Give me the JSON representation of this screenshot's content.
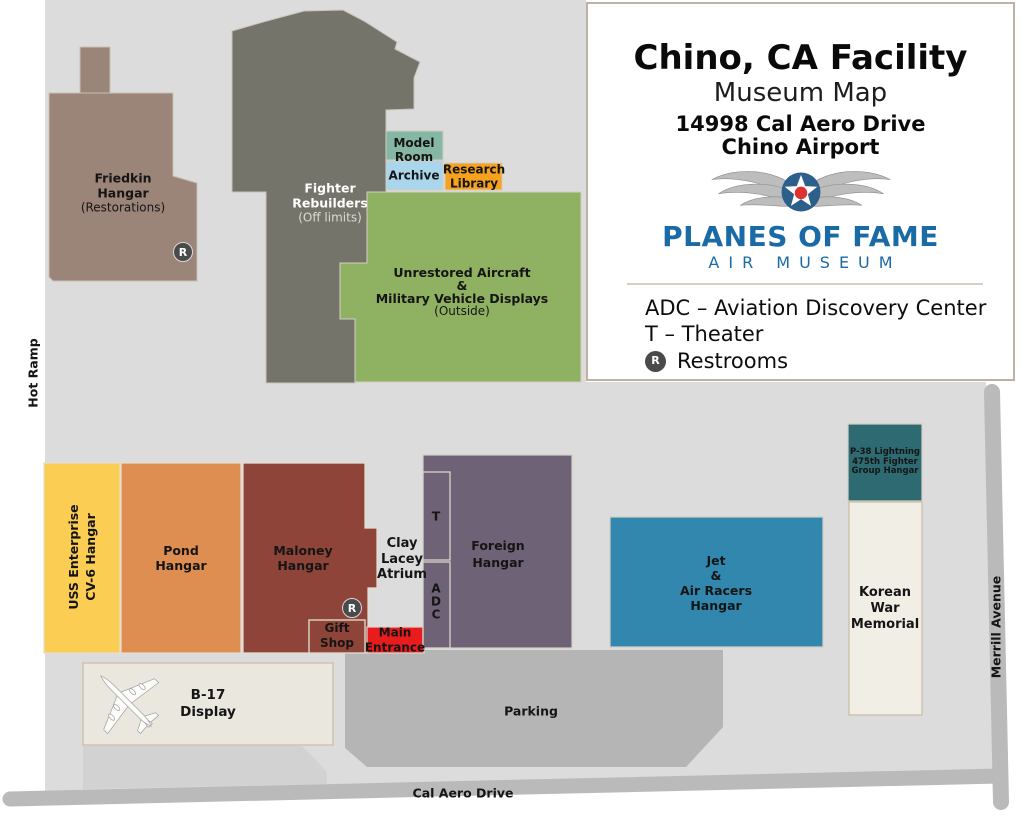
{
  "colors": {
    "ground": "#dcdcdc",
    "parking": "#b5b5b5",
    "road": "#bababa",
    "driveway": "#d2d2d2",
    "friedkin": "#9b8478",
    "fighter_rebuilders": "#75746b",
    "model_room": "#85b7a4",
    "archive": "#a9d6ea",
    "research_library": "#f6a21d",
    "unrestored_area": "#8fb162",
    "uss_enterprise": "#fbcd52",
    "pond": "#dd8e50",
    "maloney": "#8f4439",
    "gift_shop": "#8f4439",
    "main_entrance": "#e81c1c",
    "foreign": "#6e6277",
    "jet_air_racers": "#3287ae",
    "p38": "#2d6a72",
    "korean_memorial": "#f1eee6",
    "b17_display": "#eae7de",
    "restroom_marker": "#4a4a4a",
    "brand_blue": "#1a6aa6",
    "roundel_blue": "#2d5f8b",
    "roundel_red": "#dd3330"
  },
  "info_panel": {
    "title": "Chino, CA Facility",
    "subtitle": "Museum Map",
    "address_line1": "14998 Cal Aero Drive",
    "address_line2": "Chino Airport",
    "brand_name": "PLANES OF FAME",
    "brand_subtitle": "AIR MUSEUM",
    "legend_adc": "ADC – Aviation Discovery Center",
    "legend_theater": "T – Theater",
    "legend_restrooms": "Restrooms"
  },
  "buildings": {
    "friedkin": {
      "line1": "Friedkin",
      "line2": "Hangar",
      "note": "(Restorations)"
    },
    "fighter_rebuilders": {
      "line1": "Fighter",
      "line2": "Rebuilders",
      "note": "(Off limits)"
    },
    "model_room": {
      "line1": "Model",
      "line2": "Room"
    },
    "archive": {
      "label": "Archive"
    },
    "research_library": {
      "line1": "Research",
      "line2": "Library"
    },
    "unrestored": {
      "line1": "Unrestored Aircraft",
      "line2": "&",
      "line3": "Military Vehicle Displays",
      "note": "(Outside)"
    },
    "uss_enterprise": {
      "line1": "USS Enterprise",
      "line2": "CV-6 Hangar"
    },
    "pond": {
      "line1": "Pond",
      "line2": "Hangar"
    },
    "maloney": {
      "line1": "Maloney",
      "line2": "Hangar"
    },
    "gift_shop": {
      "line1": "Gift",
      "line2": "Shop"
    },
    "main_entrance": {
      "line1": "Main",
      "line2": "Entrance"
    },
    "clay_lacey": {
      "line1": "Clay",
      "line2": "Lacey",
      "line3": "Atrium"
    },
    "theater": {
      "label": "T"
    },
    "adc": {
      "letters": [
        "A",
        "D",
        "C"
      ]
    },
    "foreign": {
      "line1": "Foreign",
      "line2": "Hangar"
    },
    "jet_air_racers": {
      "line1": "Jet",
      "line2": "&",
      "line3": "Air Racers",
      "line4": "Hangar"
    },
    "p38": {
      "line1": "P-38 Lightning",
      "line2": "475th Fighter",
      "line3": "Group Hangar"
    },
    "korean_memorial": {
      "line1": "Korean",
      "line2": "War",
      "line3": "Memorial"
    },
    "b17": {
      "line1": "B-17",
      "line2": "Display"
    }
  },
  "areas": {
    "parking": "Parking"
  },
  "roads": {
    "cal_aero": "Cal Aero Drive",
    "merrill": "Merrill Avenue",
    "hot_ramp": "Hot Ramp"
  },
  "markers": {
    "restroom_letter": "R"
  }
}
